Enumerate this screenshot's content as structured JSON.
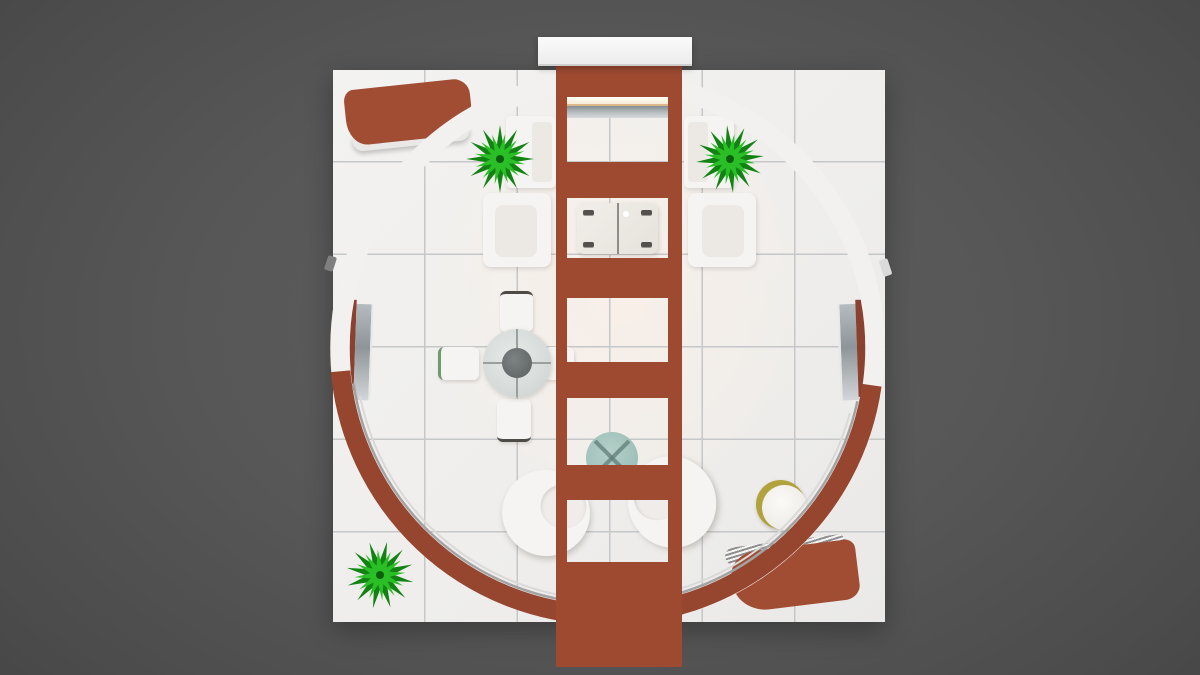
{
  "meta": {
    "title": "Top-down 3D render of a circular exhibition booth lounge floor plan",
    "width_px": 1200,
    "height_px": 675
  },
  "colors": {
    "bg": "#575757",
    "floor": "#f0efed",
    "floorWarm": "#f8efe8",
    "grout": "#c5c7c9",
    "ringWhite": "#f2f1ef",
    "ringBrown": "#96452f",
    "brown": "#9d4a31",
    "brownDeep": "#713524",
    "benchBrown": "#a04d33",
    "white": "#f5f4f2",
    "cream": "#ece9e5",
    "glass": "#d7dcda",
    "tableGray": "#636968",
    "teal": "#a0c1ba",
    "tealDark": "#5f7d77",
    "gold": "#b2a23c",
    "green": "#2bbf27",
    "greenDark": "#128312",
    "screenGray": "#8e9598",
    "glow": "#fffef4"
  },
  "objects": {
    "scene": "top-down 3d render of circular booth with central wall tower",
    "platform": "white tiled square platform, 6x6 tile grid",
    "ring": "circular booth wall ring, white upper half, terracotta lower half",
    "tower": "central terracotta tower wall with five window openings",
    "cap": "white header panel at top of tower",
    "tv": "wall-mounted media screen with light bar",
    "coffee_table": "glass coffee table seen through tower opening",
    "sofa": "white two-seat sofa",
    "armchair": "white armchair",
    "dining_table": "round glass meeting table with center column",
    "dining_chair": "white meeting chair",
    "bench": "curved terracotta bench",
    "plant": "green leafy plant",
    "egg_chair": "white egg lounge chair",
    "teal_table": "round teal side table",
    "stool": "round stool with gold rim and white top",
    "display_panel": "freestanding display panel with terracotta trim"
  }
}
